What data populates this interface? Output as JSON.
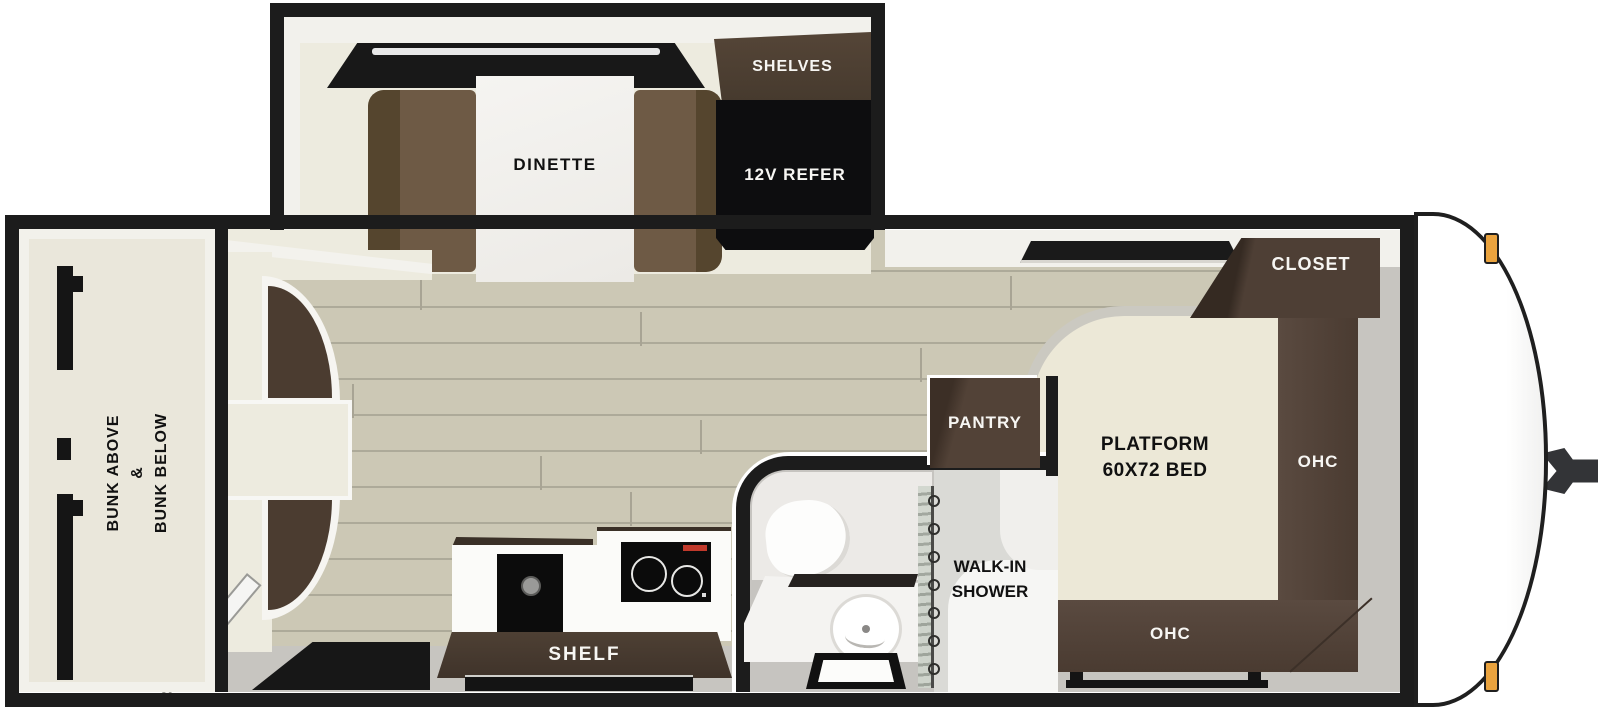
{
  "floorplan": {
    "slide_out": {
      "dinette_label": "DINETTE",
      "shelves_label": "SHELVES",
      "refer_label": "12V REFER"
    },
    "bunk_room": {
      "line1": "BUNK ABOVE",
      "line2": "&",
      "line3": "BUNK BELOW"
    },
    "kitchen": {
      "shelf_label": "SHELF"
    },
    "bathroom": {
      "shower_line1": "WALK-IN",
      "shower_line2": "SHOWER"
    },
    "pantry": {
      "label": "PANTRY"
    },
    "bedroom": {
      "bed_line1": "PLATFORM",
      "bed_line2": "60X72 BED",
      "closet_label": "CLOSET",
      "ohc_side_label": "OHC",
      "ohc_foot_label": "OHC"
    },
    "colors": {
      "wall_black": "#1c1c1c",
      "wood_floor": "#ccc8b5",
      "slide_floor": "#edebdf",
      "cabinet_dark": "#4a3b30",
      "bench_brown": "#6e5a45",
      "bed_cream": "#ece8d7",
      "gray_floor": "#c7c5c0",
      "appliance_black": "#0d0d0d",
      "marker_light_amber": "#eaa33e",
      "curtain_green": "#c2c9bf"
    }
  }
}
